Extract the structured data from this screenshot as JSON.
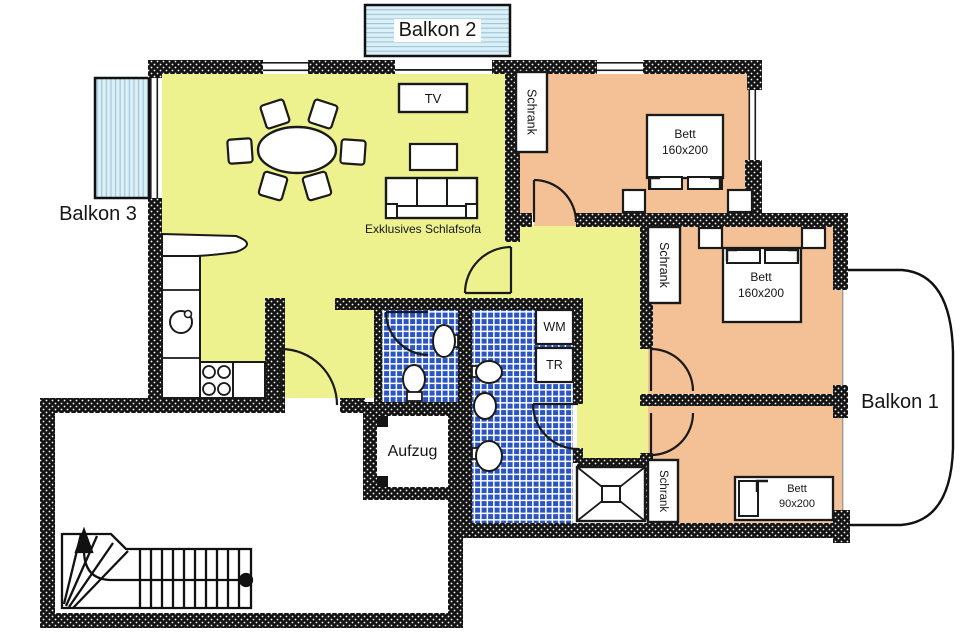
{
  "labels": {
    "balkon1": "Balkon 1",
    "balkon2": "Balkon 2",
    "balkon3": "Balkon 3",
    "tv": "TV",
    "sofa": "Exklusives Schlafsofa",
    "schrank": "Schrank",
    "bett": "Bett",
    "bett_size_double": "160x200",
    "bett_size_single": "90x200",
    "wm": "WM",
    "tr": "TR",
    "aufzug": "Aufzug"
  },
  "colors": {
    "room_yellow": "#edf28f",
    "room_orange": "#f4c196",
    "tile_blue": "#2b55c3",
    "balcony_blue": "#dbeff7",
    "wall_black": "#141414"
  }
}
